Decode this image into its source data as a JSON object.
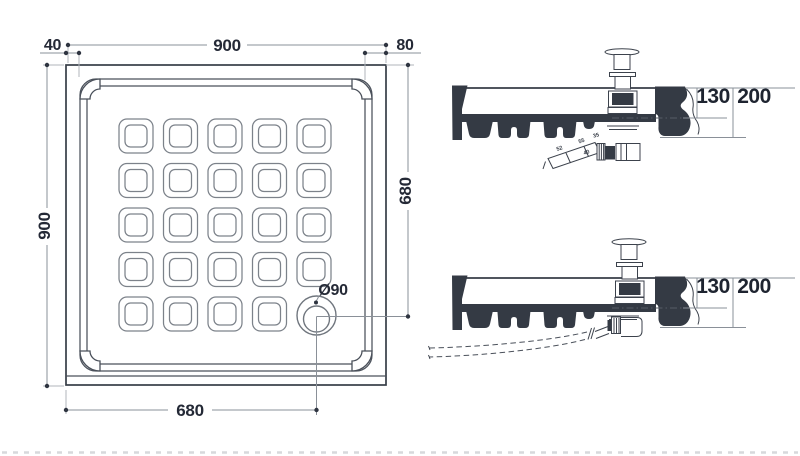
{
  "plan": {
    "label_width_total": "900",
    "label_rim_left": "40",
    "label_rim_right": "80",
    "label_height_total": "900",
    "label_drain_from_top": "680",
    "label_drain_from_left": "680",
    "label_drain_diameter": "Ø90",
    "grid": {
      "rows": 5,
      "cols": 5
    }
  },
  "section_top": {
    "label_depth": "130",
    "label_total_height": "200",
    "trap": {
      "seg_a": "52",
      "seg_b": "55",
      "nut": "35",
      "angle": "40"
    }
  },
  "section_bottom": {
    "label_depth": "130",
    "label_total_height": "200"
  },
  "colors": {
    "ink": "#242936",
    "section_fill": "#343a44",
    "line_gray": "#7c828a"
  }
}
